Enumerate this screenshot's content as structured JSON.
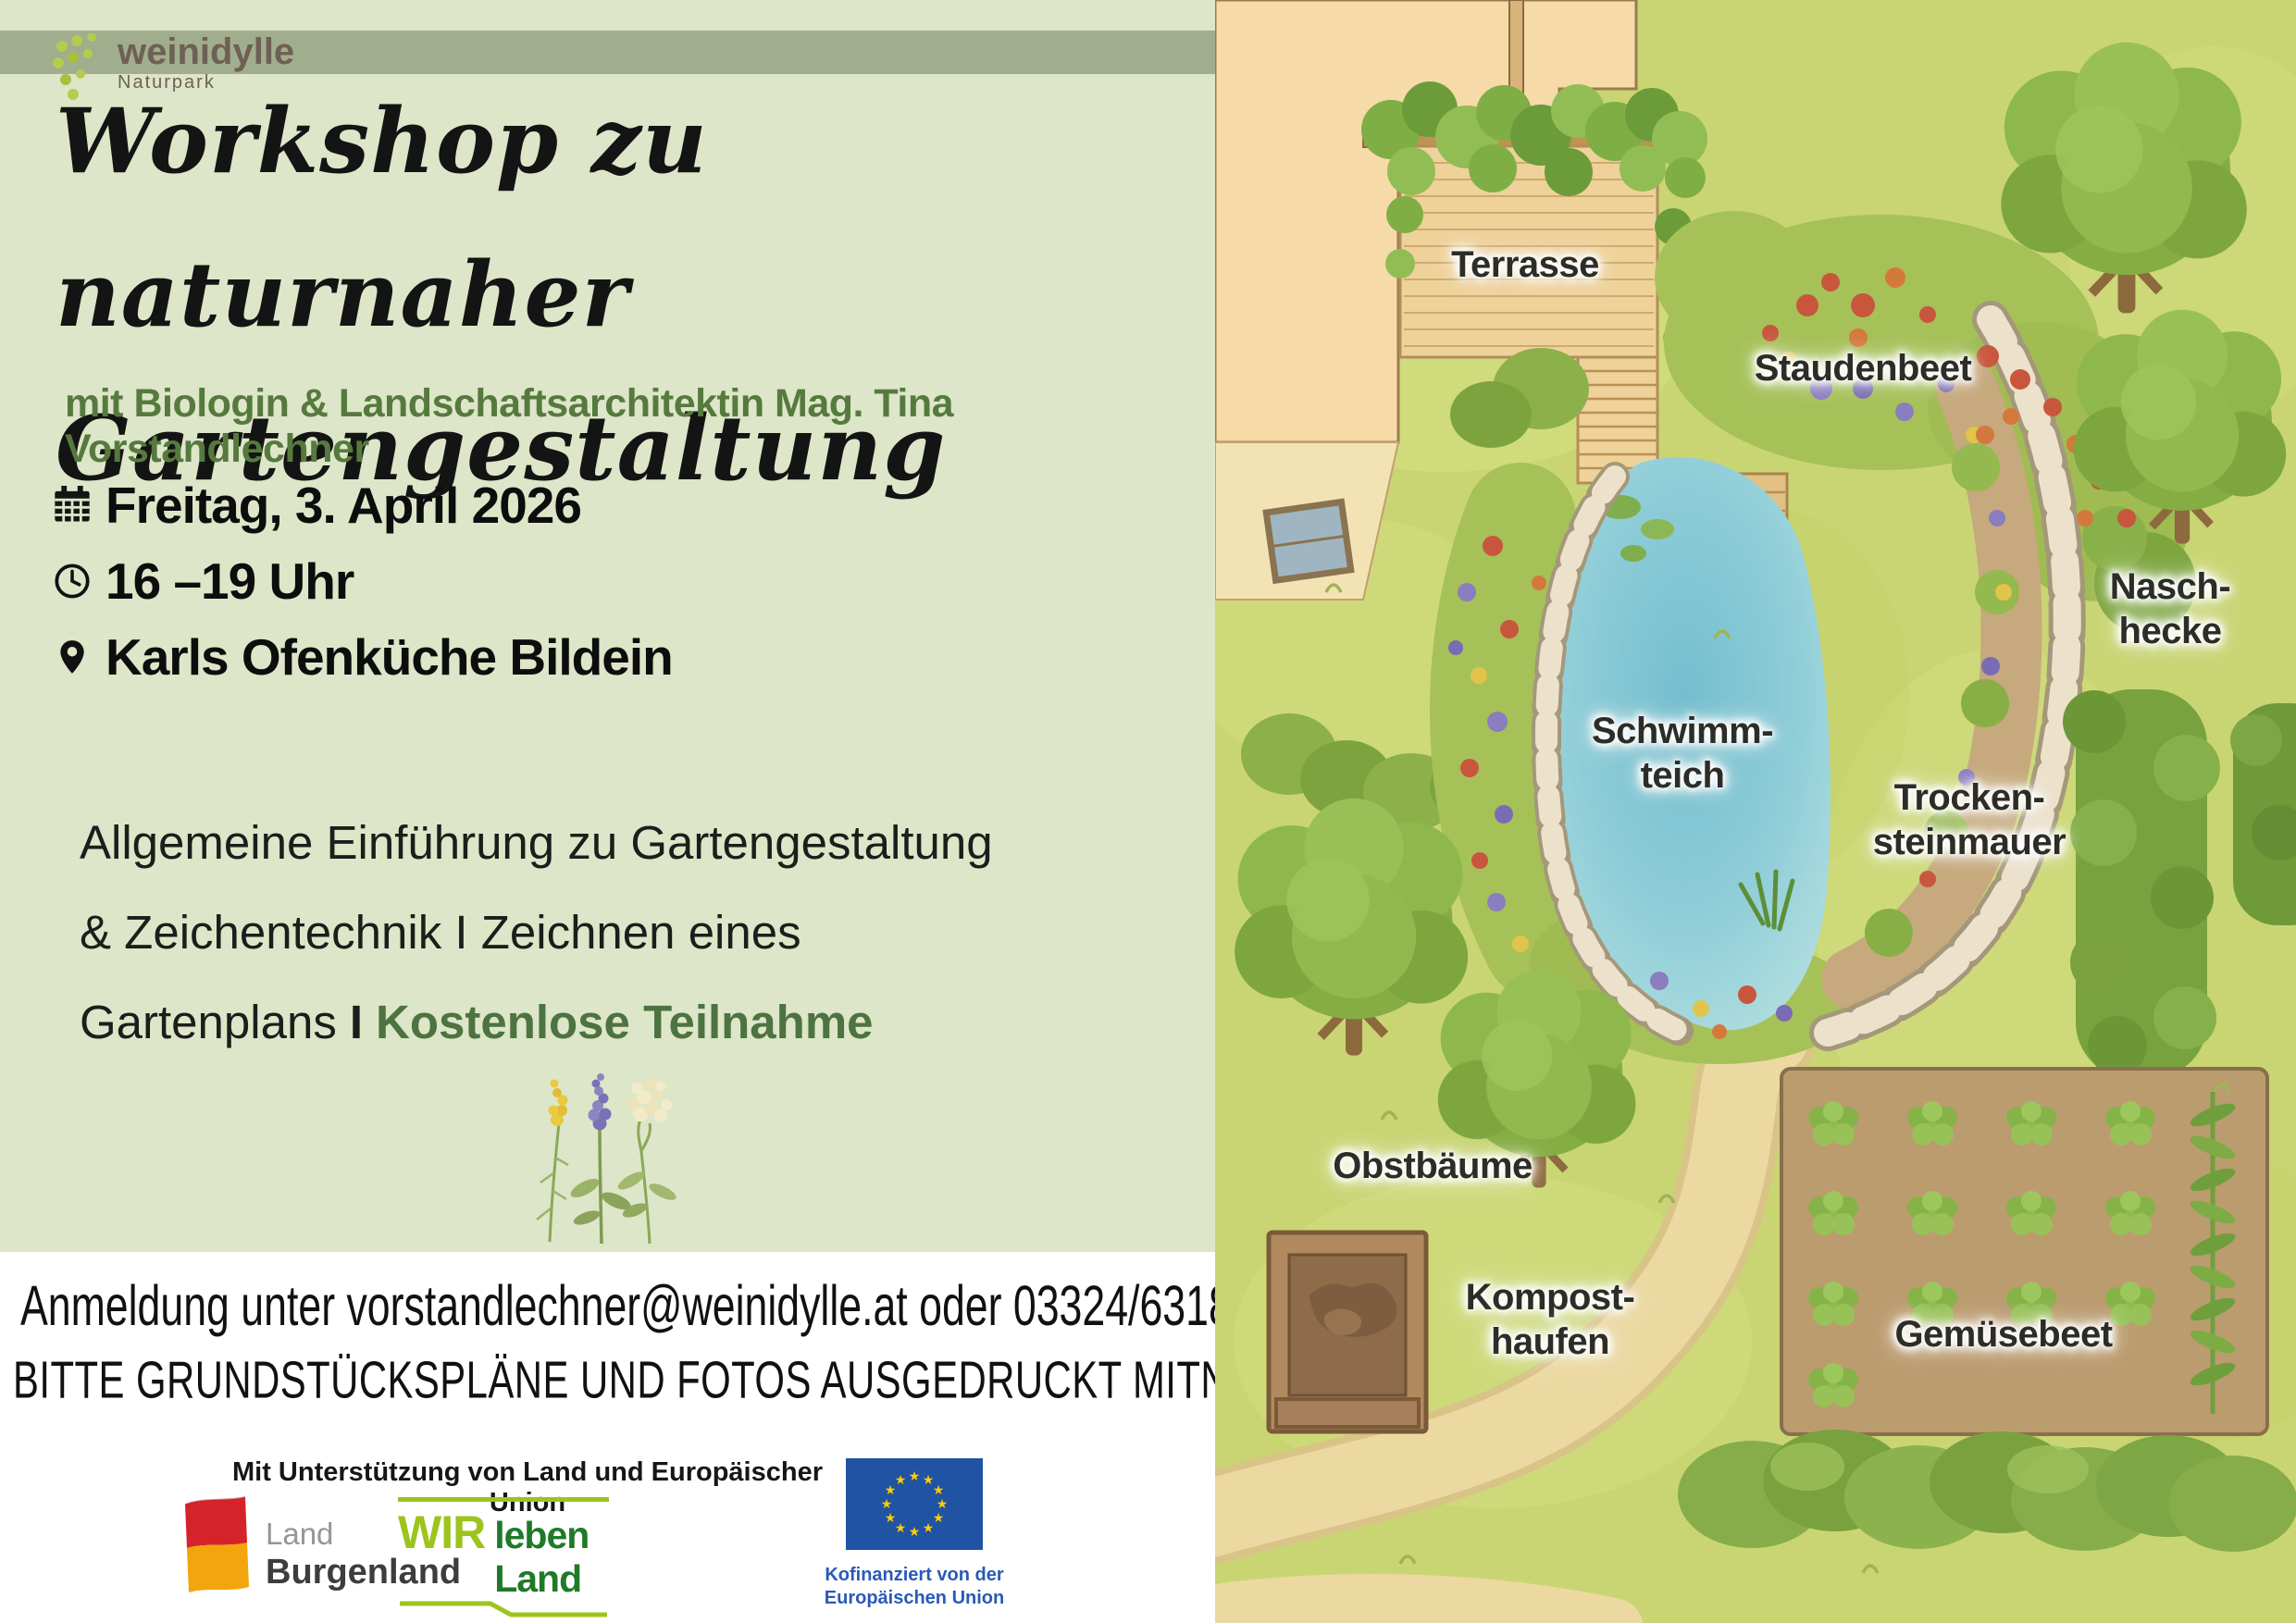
{
  "header": {
    "brand": "weinidylle",
    "brand_sub": "Naturpark"
  },
  "title": {
    "line1": "Workshop zu naturnaher",
    "line2": "Gartengestaltung"
  },
  "subtitle": "mit Biologin & Landschaftsarchitektin Mag. Tina Vorstandlechner",
  "details": [
    {
      "icon": "calendar-icon",
      "text": "Freitag, 3. April 2026"
    },
    {
      "icon": "clock-icon",
      "text": "16 –19 Uhr"
    },
    {
      "icon": "location-pin-icon",
      "text": "Karls Ofenküche Bildein"
    }
  ],
  "description": {
    "line1": "Allgemeine Einführung zu Gartengestaltung",
    "line2": "& Zeichentechnik I Zeichnen eines",
    "line3_prefix": "Gartenplans",
    "line3_sep": "I",
    "line3_highlight": "Kostenlose Teilnahme"
  },
  "contact": {
    "line1": "Anmeldung unter vorstandlechner@weinidylle.at oder 03324/6318",
    "line2": "BITTE GRUNDSTÜCKSPLÄNE UND FOTOS AUSGEDRUCKT MITNEHMEN!"
  },
  "sponsors": {
    "caption": "Mit Unterstützung von Land und Europäischer Union",
    "burgenland": {
      "line1": "Land",
      "line2": "Burgenland"
    },
    "wir": {
      "big": "WIR",
      "rest": "leben Land",
      "sub": "Gemeinsame Agrarpolitik Österreich"
    },
    "eu": {
      "caption": "Kofinanziert von der\nEuropäischen Union"
    }
  },
  "garden": {
    "labels": [
      {
        "id": "terrasse",
        "text": "Terrasse"
      },
      {
        "id": "staudenbeet",
        "text": "Staudenbeet"
      },
      {
        "id": "naschhecke",
        "text": "Nasch-\nhecke"
      },
      {
        "id": "schwimmteich",
        "text": "Schwimm-\nteich"
      },
      {
        "id": "trockensteinmauer",
        "text": "Trocken-\nsteinmauer"
      },
      {
        "id": "obstbaeume",
        "text": "Obstbäume"
      },
      {
        "id": "komposthaufen",
        "text": "Kompost-\nhaufen"
      },
      {
        "id": "gemuesebeet",
        "text": "Gemüsebeet"
      }
    ]
  },
  "icons": {
    "brand_dots": "grape-dots-icon",
    "calendar": "calendar-icon",
    "clock": "clock-icon",
    "location": "location-pin-icon",
    "flowers": "wildflowers-icon",
    "burgenland_flag": "burgenland-flag-icon",
    "eu_flag": "eu-flag-icon"
  },
  "colors": {
    "panel_bg": "#dde6c8",
    "band_bg": "#a0ae8d",
    "brand_brown": "#6e6054",
    "subtitle_green": "#567a3e",
    "highlight_green": "#4d7340",
    "lawn_green": "#c9d573",
    "pond_blue": "#8fcdd8",
    "lime_green": "#9dc41d",
    "dark_green": "#1f7a28",
    "burgenland_red": "#d5232a",
    "burgenland_gold": "#f2a50c",
    "eu_blue": "#2053a4",
    "eu_star_yellow": "#ffcc00"
  }
}
